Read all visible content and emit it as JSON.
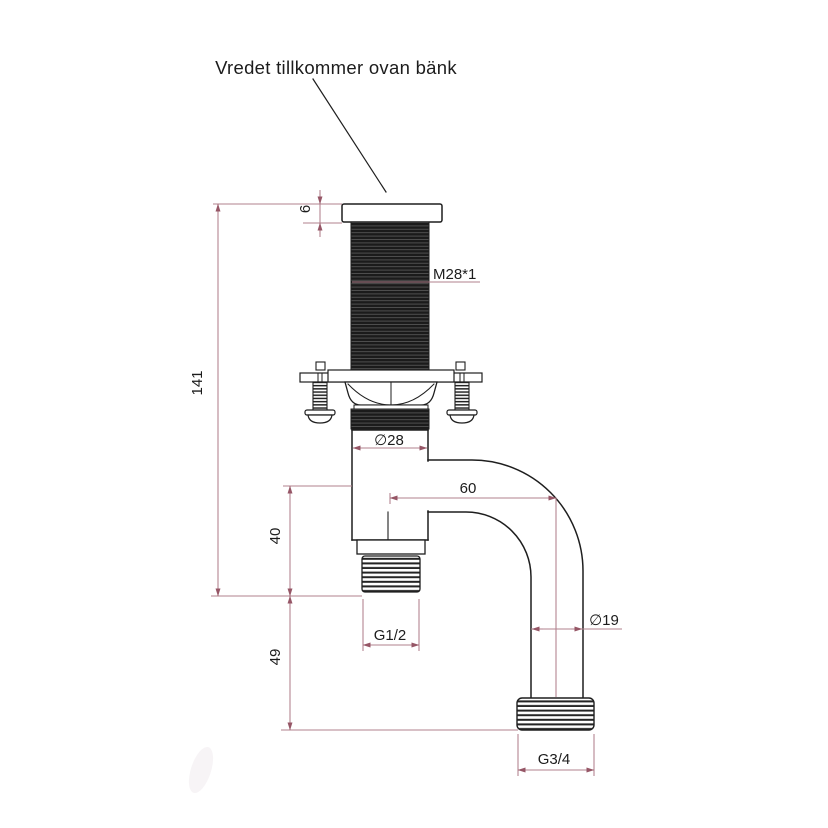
{
  "drawing": {
    "annotation": "Vredet tillkommer ovan bänk",
    "labels": {
      "cap_height": "6",
      "overall_height": "141",
      "top_thread": "M28*1",
      "body_diameter": "∅28",
      "outlet_offset": "60",
      "lower_stub_height": "40",
      "outlet_thread": "G1/2",
      "pipe_diameter": "∅19",
      "drop_height": "49",
      "pipe_end_thread": "G3/4"
    },
    "colors": {
      "outline": "#1e1e1e",
      "dimension_line": "#b1808c",
      "arrow": "#965666",
      "text": "#1c1c1c",
      "background": "#ffffff"
    }
  }
}
